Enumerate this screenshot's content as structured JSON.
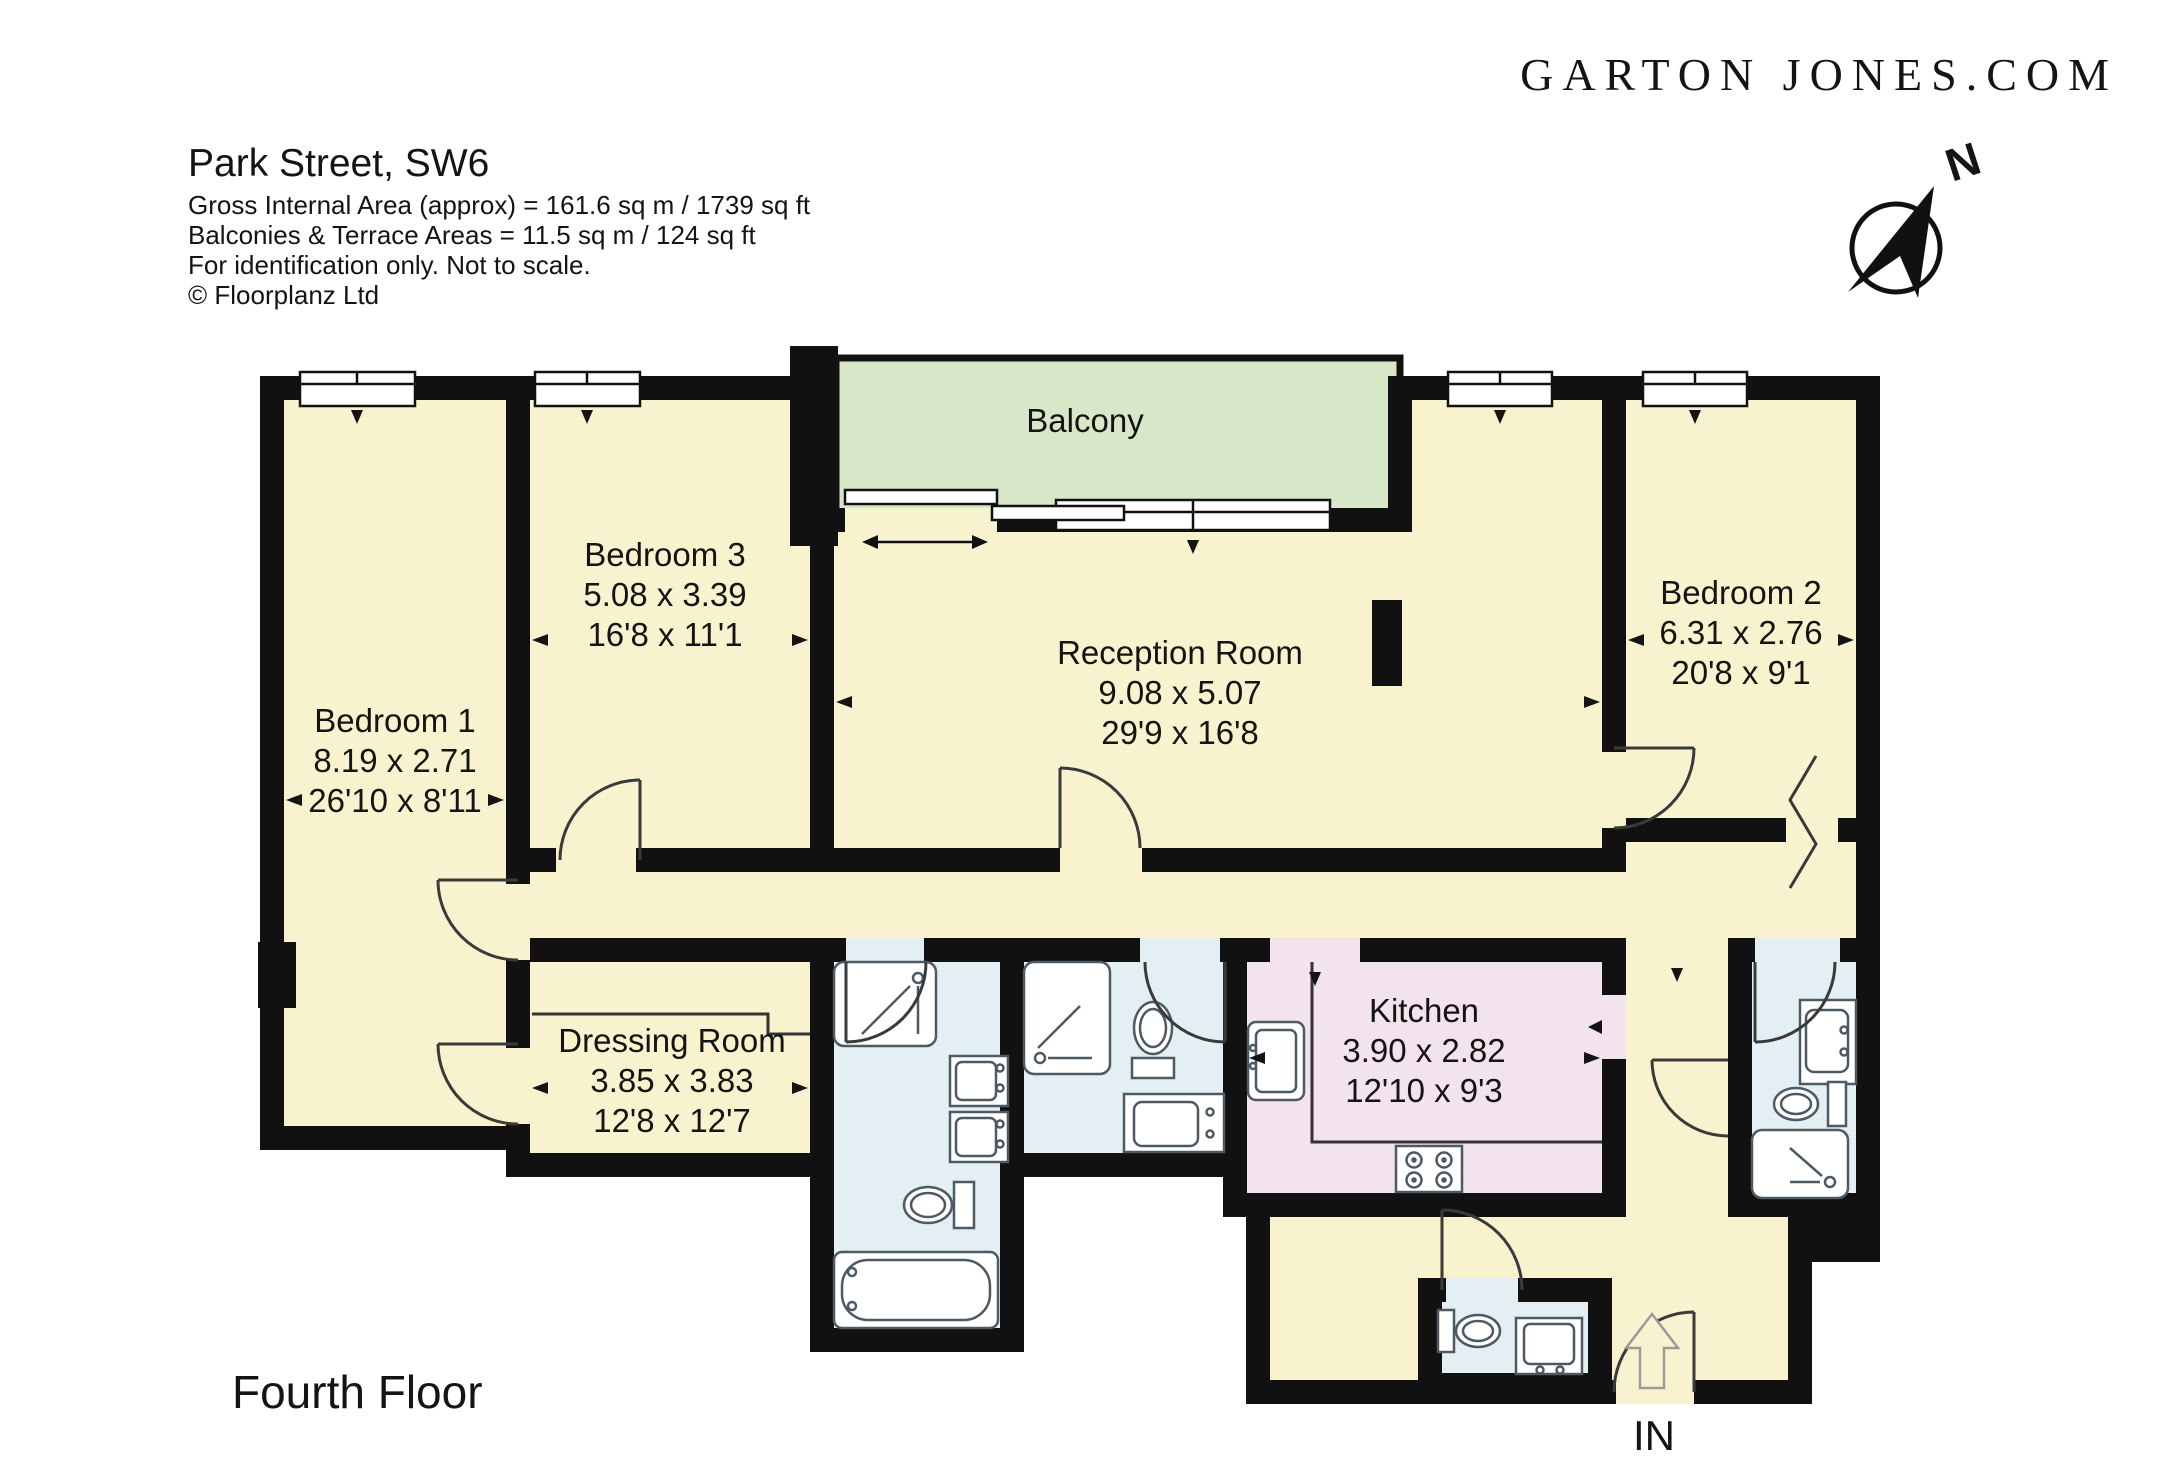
{
  "logo": {
    "text": "GARTON JONES.COM",
    "color": "#AD9453"
  },
  "header": {
    "title": "Park Street, SW6",
    "line1": "Gross Internal Area (approx) = 161.6 sq m / 1739 sq ft",
    "line2": "Balconies & Terrace Areas = 11.5 sq m / 124 sq ft",
    "line3": "For identification only. Not to scale.",
    "line4": "© Floorplanz Ltd"
  },
  "compass": {
    "north_label": "N"
  },
  "rooms": {
    "bedroom1": {
      "name": "Bedroom 1",
      "metric": "8.19 x 2.71",
      "imperial": "26'10 x 8'11"
    },
    "bedroom3": {
      "name": "Bedroom 3",
      "metric": "5.08 x 3.39",
      "imperial": "16'8 x 11'1"
    },
    "reception": {
      "name": "Reception Room",
      "metric": "9.08 x 5.07",
      "imperial": "29'9 x 16'8"
    },
    "bedroom2": {
      "name": "Bedroom 2",
      "metric": "6.31 x 2.76",
      "imperial": "20'8 x 9'1"
    },
    "dressing": {
      "name": "Dressing Room",
      "metric": "3.85 x 3.83",
      "imperial": "12'8 x 12'7"
    },
    "kitchen": {
      "name": "Kitchen",
      "metric": "3.90 x 2.82",
      "imperial": "12'10 x 9'3"
    },
    "balcony": {
      "name": "Balcony"
    }
  },
  "footer": {
    "floor_label": "Fourth Floor",
    "entrance_label": "IN"
  },
  "colors": {
    "room_fill": "#F8F3CE",
    "balcony_fill": "#D8E7C7",
    "kitchen_fill": "#F3E3EC",
    "bathroom_fill": "#E3EFF3",
    "wall": "#111111",
    "fixture_stroke": "#4d5a63",
    "logo_gold": "#AD9453"
  }
}
